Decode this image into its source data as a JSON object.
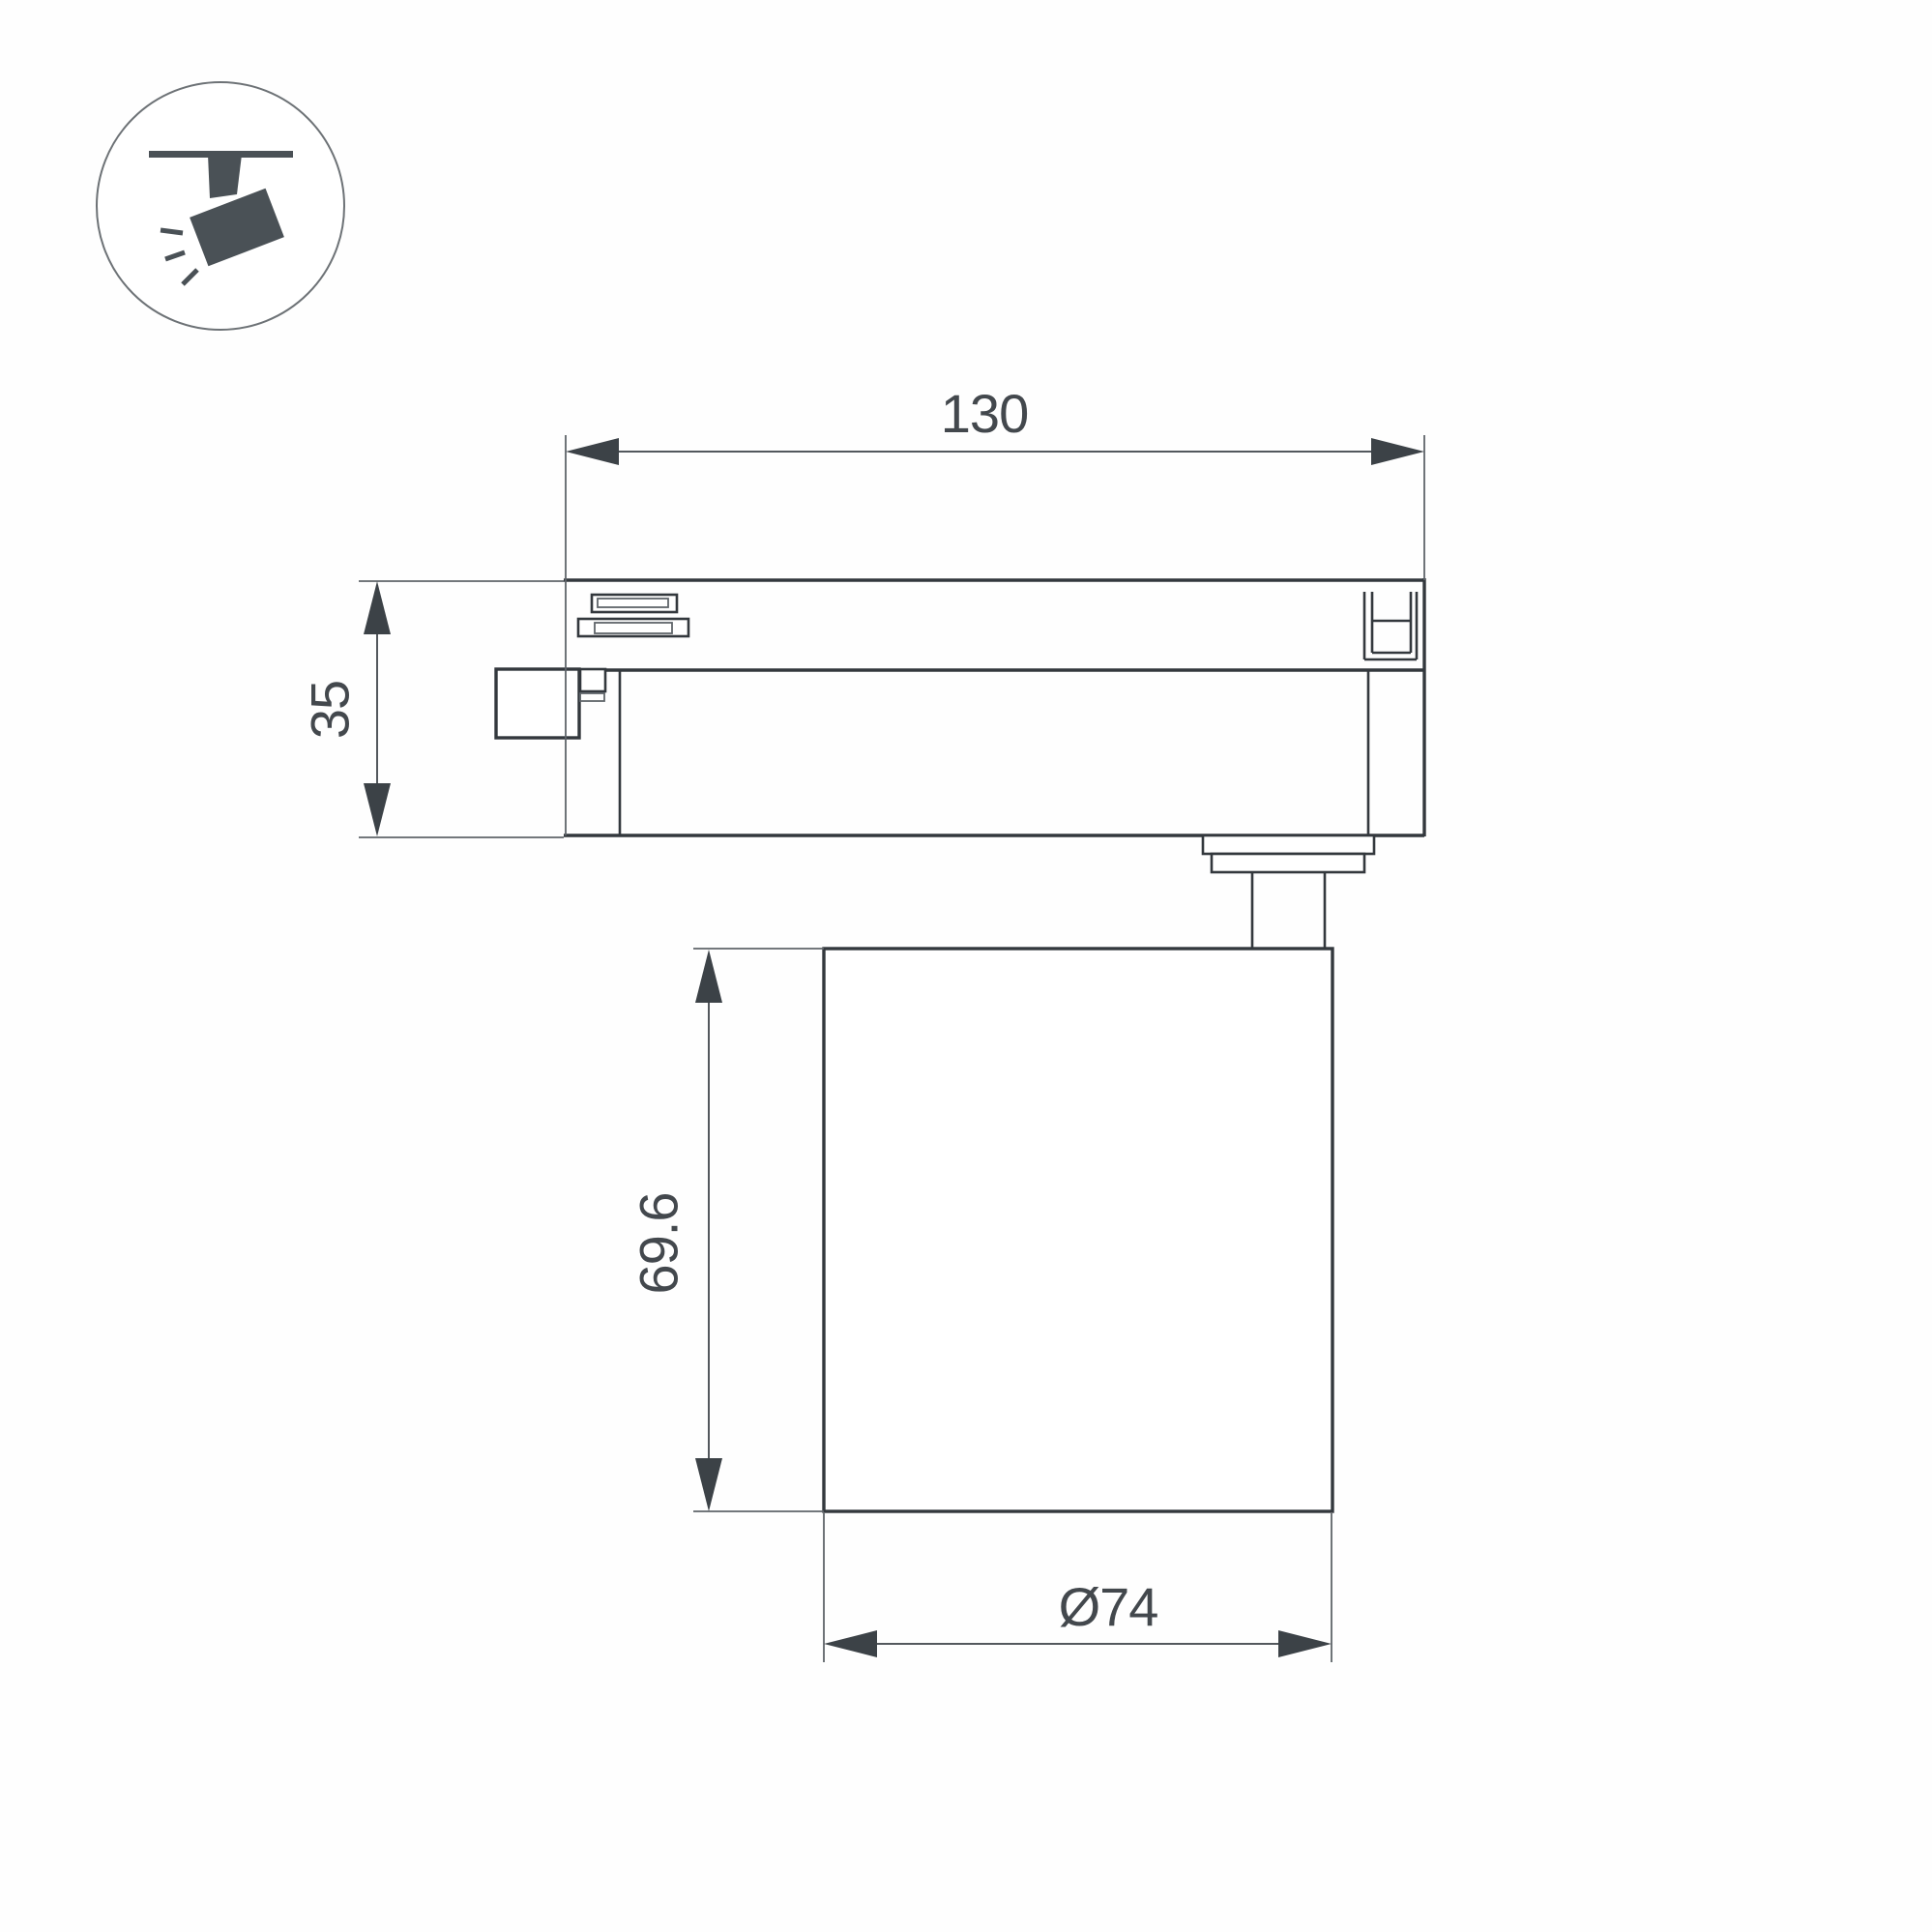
{
  "drawing": {
    "dim_width_top": "130",
    "dim_adapter_height": "35",
    "dim_body_height": "69.6",
    "dim_body_diameter": "Ø74"
  },
  "icon": {
    "name": "track-spotlight"
  },
  "colors": {
    "background": "#fefefe",
    "outline": "#33383d",
    "dim-line": "#53585d",
    "ext-line": "#5f646a",
    "arrow": "#3c4247",
    "text": "#43484d",
    "icon-fill": "#4a5156",
    "icon-ring": "#6d7276"
  }
}
